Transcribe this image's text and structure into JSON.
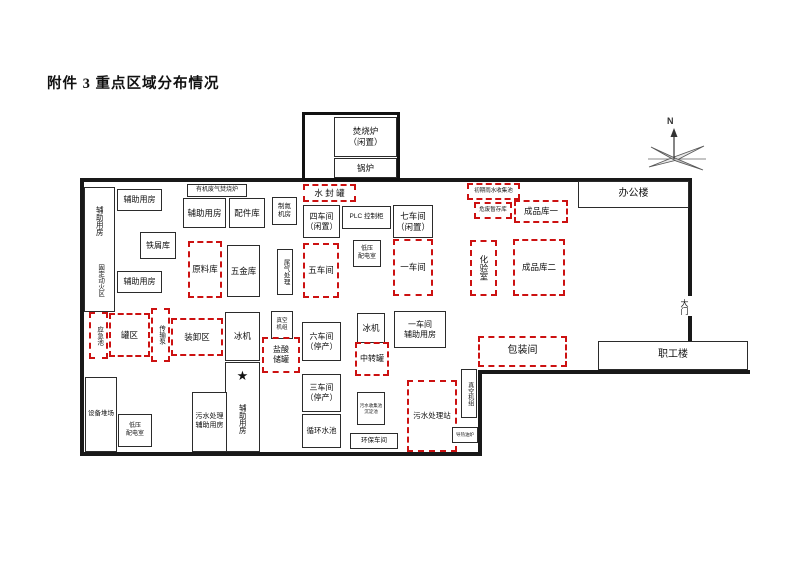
{
  "page": {
    "title": "附件 3 重点区域分布情况"
  },
  "compass": {
    "label": "N"
  },
  "colors": {
    "wall": "#191919",
    "box_border": "#2b2b2b",
    "key_area_red": "#cc1111",
    "background": "#ffffff"
  },
  "walls": [
    {
      "name": "wall-top",
      "x": 80,
      "y": 178,
      "w": 612,
      "h": 4
    },
    {
      "name": "wall-left",
      "x": 80,
      "y": 178,
      "w": 4,
      "h": 278
    },
    {
      "name": "wall-bottom",
      "x": 80,
      "y": 452,
      "w": 402,
      "h": 4
    },
    {
      "name": "wall-notch-vertical",
      "x": 478,
      "y": 370,
      "w": 4,
      "h": 86
    },
    {
      "name": "wall-notch-horizontal",
      "x": 478,
      "y": 370,
      "w": 272,
      "h": 4
    },
    {
      "name": "wall-right-upper",
      "x": 688,
      "y": 178,
      "w": 4,
      "h": 118
    },
    {
      "name": "wall-right-lower",
      "x": 688,
      "y": 316,
      "w": 4,
      "h": 58
    }
  ],
  "areas": [
    {
      "name": "incinerator-enclosure",
      "x": 302,
      "y": 112,
      "w": 98,
      "h": 69,
      "border": "thick",
      "fs": 0,
      "lines": []
    },
    {
      "name": "incinerator-idle",
      "x": 334,
      "y": 117,
      "w": 63,
      "h": 40,
      "border": "solid",
      "fs": 8.5,
      "lines": [
        "焚烧炉",
        "（闲置）"
      ]
    },
    {
      "name": "boiler",
      "x": 334,
      "y": 158,
      "w": 63,
      "h": 20,
      "border": "solid",
      "fs": 8.5,
      "lines": [
        "锅炉"
      ]
    },
    {
      "name": "aux-room-tall-box",
      "x": 84,
      "y": 187,
      "w": 31,
      "h": 125,
      "border": "solid",
      "fs": 0,
      "lines": []
    },
    {
      "name": "aux-room-tall-label",
      "x": 88,
      "y": 193,
      "w": 23,
      "h": 56,
      "border": "none",
      "vertical": true,
      "fs": 7.5,
      "lines": [
        "辅助用房"
      ]
    },
    {
      "name": "fixed-hotwork-zone",
      "x": 88,
      "y": 251,
      "w": 23,
      "h": 58,
      "border": "none",
      "vertical": true,
      "fs": 6.5,
      "lines": [
        "固定动火区"
      ]
    },
    {
      "name": "aux-room-northwest",
      "x": 117,
      "y": 189,
      "w": 45,
      "h": 22,
      "border": "solid",
      "fs": 8,
      "lines": [
        "辅助用房"
      ]
    },
    {
      "name": "scrap-store",
      "x": 140,
      "y": 232,
      "w": 36,
      "h": 27,
      "border": "solid",
      "fs": 8,
      "lines": [
        "铁屑库"
      ]
    },
    {
      "name": "aux-room-west",
      "x": 117,
      "y": 271,
      "w": 45,
      "h": 22,
      "border": "solid",
      "fs": 8,
      "lines": [
        "辅助用房"
      ]
    },
    {
      "name": "organic-waste-gas-furnace",
      "x": 187,
      "y": 184,
      "w": 60,
      "h": 13,
      "border": "solid",
      "fs": 6,
      "lines": [
        "有机废气焚烧炉"
      ]
    },
    {
      "name": "aux-room-north",
      "x": 183,
      "y": 198,
      "w": 43,
      "h": 30,
      "border": "solid",
      "fs": 8.5,
      "lines": [
        "辅助用房"
      ]
    },
    {
      "name": "parts-warehouse",
      "x": 229,
      "y": 198,
      "w": 36,
      "h": 30,
      "border": "solid",
      "fs": 8.5,
      "lines": [
        "配件库"
      ]
    },
    {
      "name": "nitrogen-generator-room",
      "x": 272,
      "y": 197,
      "w": 25,
      "h": 28,
      "border": "solid",
      "fs": 6.5,
      "lines": [
        "制氮",
        "机房"
      ]
    },
    {
      "name": "water-seal-tank",
      "x": 303,
      "y": 184,
      "w": 53,
      "h": 18,
      "border": "dashed",
      "fs": 8.5,
      "lines": [
        "水 封 罐"
      ]
    },
    {
      "name": "workshop-4-idle",
      "x": 303,
      "y": 205,
      "w": 37,
      "h": 33,
      "border": "solid",
      "fs": 8,
      "lines": [
        "四车间",
        "（闲置）"
      ]
    },
    {
      "name": "plc-control-cabinet",
      "x": 342,
      "y": 206,
      "w": 49,
      "h": 23,
      "border": "solid",
      "fs": 6.5,
      "lines": [
        "PLC 控制柜"
      ]
    },
    {
      "name": "workshop-7-idle",
      "x": 393,
      "y": 205,
      "w": 40,
      "h": 33,
      "border": "solid",
      "fs": 8.5,
      "lines": [
        "七车间",
        "（闲置）"
      ]
    },
    {
      "name": "raw-material-warehouse",
      "x": 188,
      "y": 241,
      "w": 34,
      "h": 57,
      "border": "dashed",
      "fs": 8.5,
      "lines": [
        "原料库"
      ]
    },
    {
      "name": "hardware-warehouse",
      "x": 227,
      "y": 245,
      "w": 33,
      "h": 52,
      "border": "solid",
      "fs": 8.5,
      "lines": [
        "五金库"
      ]
    },
    {
      "name": "tail-gas-treatment",
      "x": 277,
      "y": 249,
      "w": 16,
      "h": 46,
      "border": "solid",
      "vertical": true,
      "fs": 6.5,
      "lines": [
        "尾气处理"
      ]
    },
    {
      "name": "workshop-5",
      "x": 303,
      "y": 243,
      "w": 36,
      "h": 55,
      "border": "dashed",
      "fs": 8.5,
      "lines": [
        "五车间"
      ]
    },
    {
      "name": "lv-distribution-room-north",
      "x": 353,
      "y": 240,
      "w": 28,
      "h": 27,
      "border": "solid",
      "fs": 6,
      "lines": [
        "低压",
        "配电室"
      ]
    },
    {
      "name": "workshop-1",
      "x": 393,
      "y": 239,
      "w": 40,
      "h": 57,
      "border": "dashed",
      "fs": 8.5,
      "lines": [
        "一车间"
      ]
    },
    {
      "name": "laboratory",
      "x": 470,
      "y": 240,
      "w": 27,
      "h": 56,
      "border": "dashed",
      "vertical": true,
      "fs": 8.5,
      "lines": [
        "化验室"
      ]
    },
    {
      "name": "finished-goods-warehouse-2",
      "x": 513,
      "y": 239,
      "w": 52,
      "h": 57,
      "border": "dashed",
      "fs": 8.5,
      "lines": [
        "成品库二"
      ]
    },
    {
      "name": "initial-rainwater-pool",
      "x": 467,
      "y": 183,
      "w": 53,
      "h": 17,
      "border": "dashed",
      "fs": 5.5,
      "lines": [
        "初期雨水收集池"
      ]
    },
    {
      "name": "hazardous-waste-storage",
      "x": 474,
      "y": 202,
      "w": 38,
      "h": 17,
      "border": "dashed",
      "fs": 5.5,
      "lines": [
        "危废暂存库"
      ]
    },
    {
      "name": "finished-goods-warehouse-1",
      "x": 514,
      "y": 200,
      "w": 54,
      "h": 23,
      "border": "dashed",
      "fs": 8.5,
      "lines": [
        "成品库一"
      ]
    },
    {
      "name": "office-building",
      "x": 578,
      "y": 181,
      "w": 111,
      "h": 27,
      "border": "solid",
      "bg": false,
      "fs": 10,
      "lines": [
        "办公楼"
      ]
    },
    {
      "name": "emergency-pool",
      "x": 89,
      "y": 312,
      "w": 19,
      "h": 47,
      "border": "dashed",
      "vertical": true,
      "fs": 6.5,
      "lines": [
        "应急池"
      ]
    },
    {
      "name": "tank-farm",
      "x": 109,
      "y": 313,
      "w": 41,
      "h": 44,
      "border": "dashed",
      "fs": 8.5,
      "lines": [
        "罐区"
      ]
    },
    {
      "name": "transfer-pump",
      "x": 151,
      "y": 308,
      "w": 19,
      "h": 54,
      "border": "dashed",
      "vertical": true,
      "fs": 6.5,
      "lines": [
        "传输泵"
      ]
    },
    {
      "name": "loading-unloading-area",
      "x": 171,
      "y": 318,
      "w": 52,
      "h": 38,
      "border": "dashed",
      "fs": 8.5,
      "lines": [
        "装卸区"
      ]
    },
    {
      "name": "chiller-west",
      "x": 225,
      "y": 312,
      "w": 35,
      "h": 49,
      "border": "solid",
      "fs": 8.5,
      "lines": [
        "冰机"
      ]
    },
    {
      "name": "aux-room-star-box",
      "x": 225,
      "y": 362,
      "w": 35,
      "h": 90,
      "border": "solid",
      "fs": 0,
      "lines": []
    },
    {
      "name": "star-icon",
      "x": 229,
      "y": 366,
      "w": 27,
      "h": 20,
      "border": "none",
      "fs": 13,
      "lines": [
        "★"
      ]
    },
    {
      "name": "aux-room-south",
      "x": 230,
      "y": 390,
      "w": 25,
      "h": 58,
      "border": "none",
      "vertical": true,
      "fs": 7.5,
      "lines": [
        "辅助用房"
      ]
    },
    {
      "name": "vacuum-unit-center",
      "x": 271,
      "y": 311,
      "w": 22,
      "h": 28,
      "border": "solid",
      "fs": 5.5,
      "lines": [
        "真空",
        "机组"
      ]
    },
    {
      "name": "hydrochloric-acid-tank",
      "x": 262,
      "y": 337,
      "w": 38,
      "h": 36,
      "border": "dashed",
      "fs": 8,
      "lines": [
        "盐酸",
        "储罐"
      ]
    },
    {
      "name": "workshop-6-stopped",
      "x": 302,
      "y": 322,
      "w": 39,
      "h": 39,
      "border": "solid",
      "fs": 8,
      "lines": [
        "六车间",
        "（停产）"
      ]
    },
    {
      "name": "chiller-center",
      "x": 357,
      "y": 313,
      "w": 28,
      "h": 30,
      "border": "solid",
      "fs": 8.5,
      "lines": [
        "冰机"
      ]
    },
    {
      "name": "transfer-tank",
      "x": 355,
      "y": 342,
      "w": 34,
      "h": 34,
      "border": "dashed",
      "fs": 8,
      "lines": [
        "中转罐"
      ]
    },
    {
      "name": "workshop-1-aux-room",
      "x": 394,
      "y": 311,
      "w": 52,
      "h": 37,
      "border": "solid",
      "fs": 8,
      "lines": [
        "一车间",
        "辅助用房"
      ]
    },
    {
      "name": "equipment-yard",
      "x": 85,
      "y": 377,
      "w": 32,
      "h": 75,
      "border": "solid",
      "fs": 6.5,
      "lines": [
        "设备堆场"
      ]
    },
    {
      "name": "lv-distribution-room-south",
      "x": 118,
      "y": 414,
      "w": 34,
      "h": 33,
      "border": "solid",
      "fs": 6,
      "lines": [
        "低压",
        "配电室"
      ]
    },
    {
      "name": "sewage-treatment-aux-room",
      "x": 192,
      "y": 392,
      "w": 35,
      "h": 60,
      "border": "solid",
      "fs": 7,
      "lines": [
        "污水处理",
        "辅助用房"
      ]
    },
    {
      "name": "workshop-3-stopped",
      "x": 302,
      "y": 374,
      "w": 39,
      "h": 38,
      "border": "solid",
      "fs": 8,
      "lines": [
        "三车间",
        "（停产）"
      ]
    },
    {
      "name": "circulating-water-pool",
      "x": 302,
      "y": 414,
      "w": 39,
      "h": 34,
      "border": "solid",
      "fs": 7.5,
      "lines": [
        "循环水池"
      ]
    },
    {
      "name": "wastewater-collect-pool",
      "x": 357,
      "y": 392,
      "w": 28,
      "h": 33,
      "border": "solid",
      "fs": 4.5,
      "lines": [
        "污水收集池",
        "沉淀池"
      ]
    },
    {
      "name": "sewage-treatment-station",
      "x": 407,
      "y": 380,
      "w": 50,
      "h": 72,
      "border": "dashed",
      "fs": 7.5,
      "lines": [
        "污水处理站"
      ]
    },
    {
      "name": "environmental-workshop",
      "x": 350,
      "y": 433,
      "w": 48,
      "h": 16,
      "border": "solid",
      "fs": 6.5,
      "lines": [
        "环保车间"
      ]
    },
    {
      "name": "packing-room",
      "x": 478,
      "y": 336,
      "w": 89,
      "h": 31,
      "border": "dashed",
      "fs": 10,
      "lines": [
        "包装间"
      ]
    },
    {
      "name": "vacuum-unit-east",
      "x": 461,
      "y": 369,
      "w": 16,
      "h": 49,
      "border": "solid",
      "vertical": true,
      "fs": 6,
      "lines": [
        "真空机组"
      ]
    },
    {
      "name": "heat-oil-furnace",
      "x": 452,
      "y": 427,
      "w": 26,
      "h": 16,
      "border": "solid",
      "fs": 4.5,
      "lines": [
        "导热油炉"
      ]
    },
    {
      "name": "staff-building",
      "x": 598,
      "y": 341,
      "w": 150,
      "h": 29,
      "border": "solid",
      "fs": 10,
      "lines": [
        "职工楼"
      ]
    },
    {
      "name": "main-gate",
      "x": 676,
      "y": 293,
      "w": 16,
      "h": 28,
      "border": "none",
      "vertical": true,
      "fs": 8,
      "lines": [
        "大门"
      ]
    }
  ]
}
